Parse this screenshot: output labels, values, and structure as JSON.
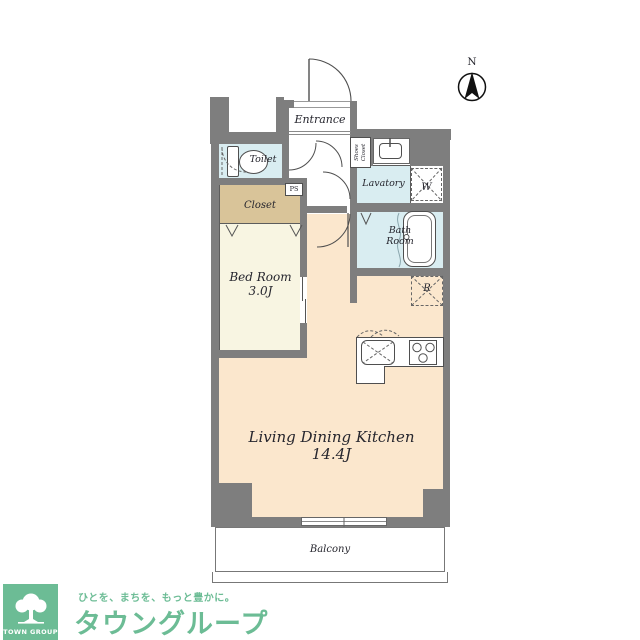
{
  "plan": {
    "compass_label": "N",
    "rooms": {
      "entrance": "Entrance",
      "toilet": "Toilet",
      "shoes_closet_line1": "Shoes",
      "shoes_closet_line2": "Closet",
      "lavatory": "Lavatory",
      "washer_space": "W",
      "bath_line1": "Bath",
      "bath_line2": "Room",
      "refrigerator_space": "R",
      "pipe_space": "PS",
      "closet": "Closet",
      "bedroom": "Bed Room",
      "bedroom_size": "3.0J",
      "ldk": "Living Dining Kitchen",
      "ldk_size": "14.4J",
      "balcony": "Balcony"
    },
    "colors": {
      "wall": "#7e7e7e",
      "wet": "#d9edf1",
      "closet": "#d9c499",
      "bedroom": "#f8f5e2",
      "ldk": "#fbe7cd",
      "line": "#4f4f4f",
      "brand": "#6cbc95"
    }
  },
  "footer": {
    "badge": "TOWN GROUP",
    "tagline": "ひとを、まちを、もっと豊かに。",
    "brand": "タウングループ"
  }
}
